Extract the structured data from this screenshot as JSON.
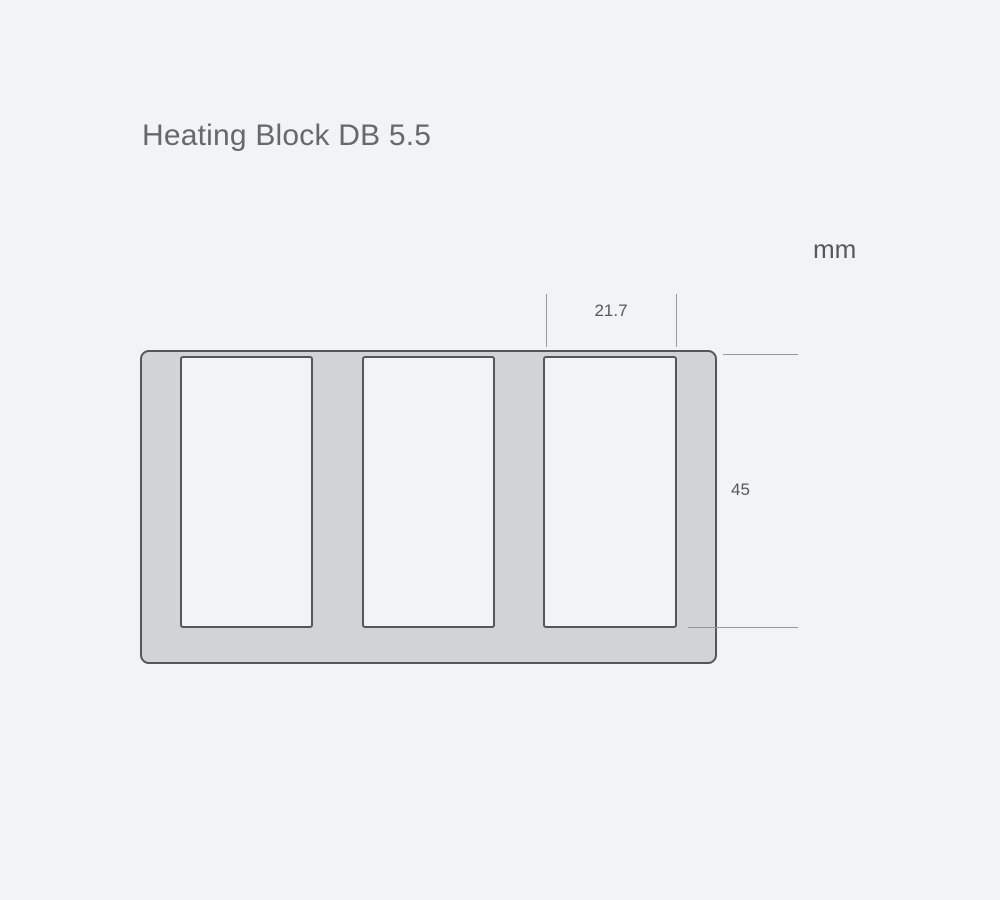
{
  "page": {
    "title": "Heating Block DB 5.5",
    "unit_label": "mm"
  },
  "diagram": {
    "name": "heating-block-cross-section",
    "well_count": 3,
    "dimensions": {
      "well_width": "21.7",
      "well_depth": "45",
      "unit": "mm"
    },
    "colors": {
      "background": "#f2f3f5",
      "block_fill": "#d2d3d5",
      "block_outline": "#55565a",
      "dimension_line": "#97989b",
      "text": "#57585a",
      "title_text": "#66686c"
    }
  }
}
